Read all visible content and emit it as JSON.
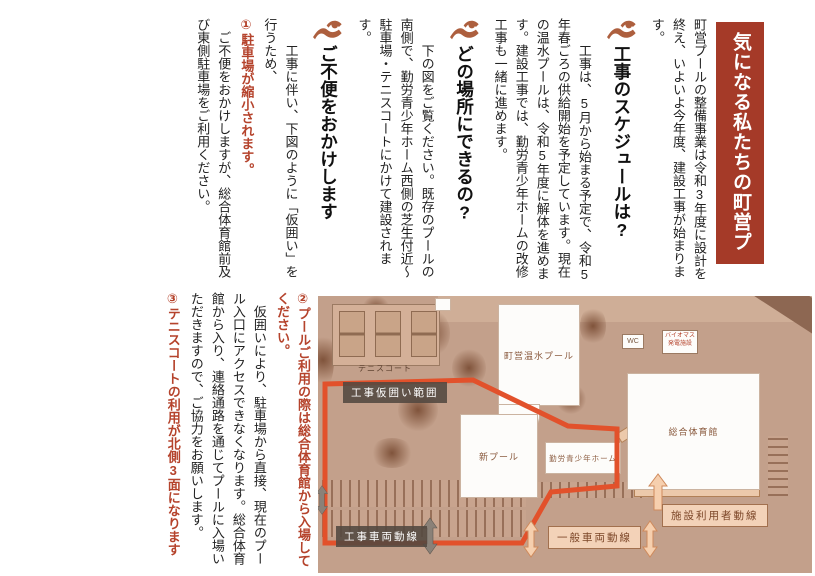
{
  "banner": {
    "title": "気になる私たちの町営プール"
  },
  "intro": "町営プールの整備事業は令和3年度に設計を終え、いよいよ今年度、建設工事が始まります。",
  "sections": [
    {
      "heading": "工事のスケジュールは?",
      "body": "工事は、5月から始まる予定で、令和5年春ごろの供給開始を予定しています。現在の温水プールは、令和5年度に解体を進めます。建設工事では、勤労青少年ホームの改修工事も一緒に進めます。"
    },
    {
      "heading": "どの場所にできるの?",
      "body": "下の図をご覧ください。既存のプールの南側で、勤労青少年ホーム西側の芝生付近〜駐車場・テニスコートにかけて建設されます。"
    },
    {
      "heading": "ご不便をおかけします",
      "body": "工事に伴い、下図のように「仮囲い」を行うため、"
    }
  ],
  "notices": [
    {
      "number_text": "①駐車場が縮小されます。",
      "body": "ご不便をおかけしますが、総合体育館前及び東側駐車場をご利用ください。"
    },
    {
      "number_text": "②プールご利用の際は総合体育館から入場してください。",
      "body": "仮囲いにより、駐車場から直接、現在のプール入口にアクセスできなくなります。総合体育館から入り、連絡通路を通じてプールに入場いただきますので、ご協力をお願いします。"
    },
    {
      "number_text": "③テニスコートの利用が北側3面になります",
      "body": ""
    }
  ],
  "map": {
    "tennis_court": "テニスコート",
    "heated_pool": "町営温水プール",
    "gymnasium": "総合体育館",
    "new_pool": "新プール",
    "youth_home": "勤労青少年ホーム",
    "wc": "WC",
    "biomass_line1": "バイオマス",
    "biomass_line2": "発電施設",
    "fence_range": "工事仮囲い範囲",
    "construction_vehicles": "工事車両動線",
    "general_vehicles": "一般車両動線",
    "facility_users": "施設利用者動線"
  },
  "colors": {
    "banner_bg": "#a53a28",
    "accent_red_text": "#b5432c",
    "swimmer_icon": "#ad5f3e",
    "fence_line": "#e2512b",
    "map_base": "#c3a08b"
  }
}
